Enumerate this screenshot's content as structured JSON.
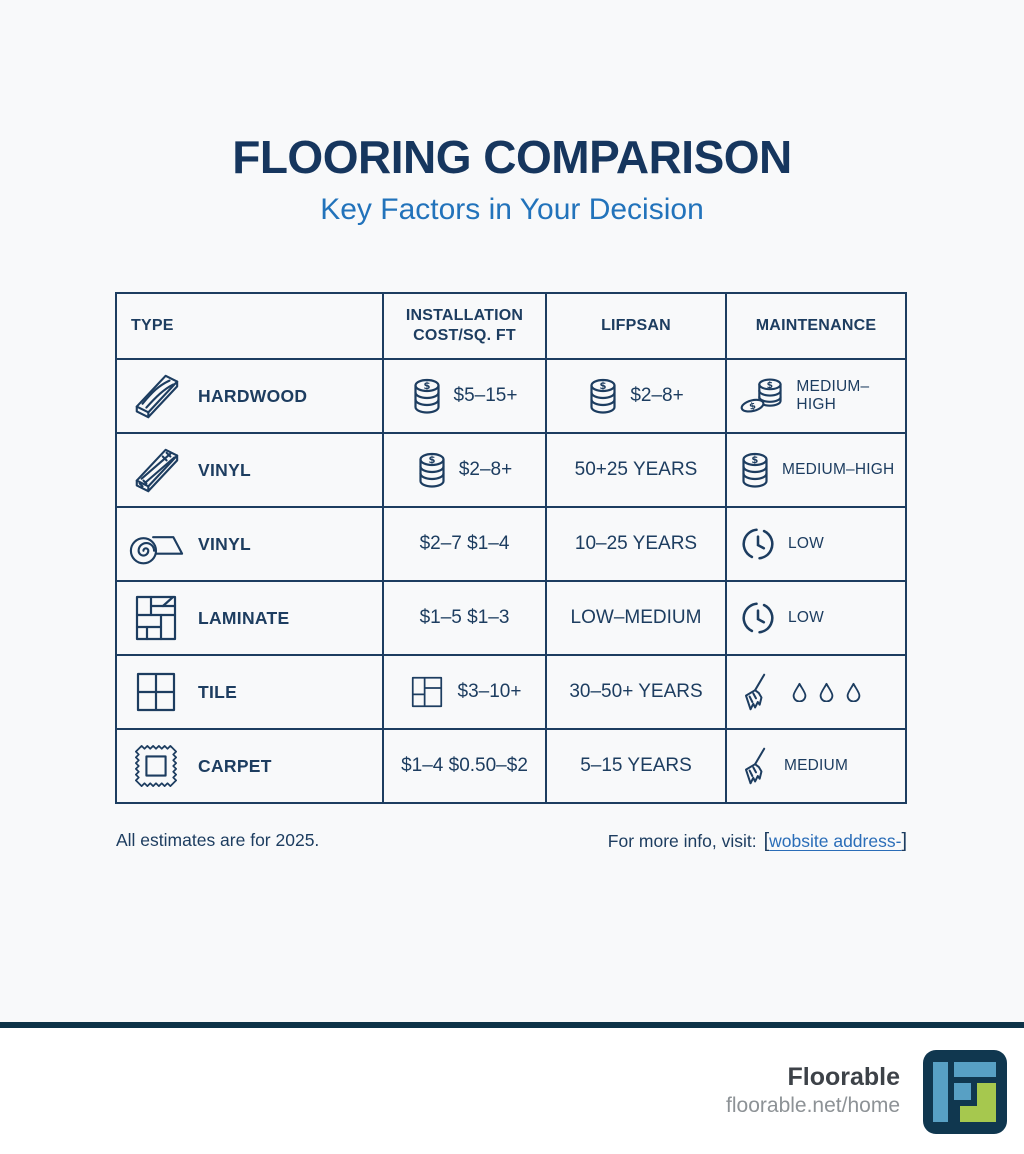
{
  "page": {
    "title": "FLOORING COMPARISON",
    "subtitle": "Key Factors in Your Decision"
  },
  "colors": {
    "navy": "#1d3d60",
    "heading_blue": "#2273bb",
    "link_blue": "#2a6db8",
    "footer_rule": "#0d3348",
    "logo_blue": "#58a0c4",
    "logo_green": "#a6c84e",
    "logo_navy": "#10374f"
  },
  "table": {
    "headers": [
      "TYPE",
      "INSTALLATION COST/SQ. FT",
      "LIFPSAN",
      "MAINTENANCE"
    ],
    "rows": [
      {
        "type": {
          "icon": "hardwood-plank-icon",
          "label": "HARDWOOD"
        },
        "cost": {
          "icon": "coin-stack-icon",
          "value": "$5–15+"
        },
        "lifespan": {
          "icon": "coin-stack-icon",
          "value": "$2–8+"
        },
        "maintenance": {
          "icon": "coin-pile-icon",
          "value": "MEDIUM–HIGH"
        }
      },
      {
        "type": {
          "icon": "vinyl-plank-icon",
          "label": "VINYL"
        },
        "cost": {
          "icon": "coin-stack-icon",
          "value": "$2–8+"
        },
        "lifespan": {
          "icon": "",
          "value": "50+25 YEARS"
        },
        "maintenance": {
          "icon": "coin-stack-icon",
          "value": "MEDIUM–HIGH"
        }
      },
      {
        "type": {
          "icon": "vinyl-roll-icon",
          "label": "VINYL"
        },
        "cost": {
          "icon": "",
          "value": "$2–7  $1–4"
        },
        "lifespan": {
          "icon": "",
          "value": "10–25 YEARS"
        },
        "maintenance": {
          "icon": "clock-icon",
          "value": "LOW"
        }
      },
      {
        "type": {
          "icon": "laminate-parquet-icon",
          "label": "LAMINATE"
        },
        "cost": {
          "icon": "",
          "value": "$1–5  $1–3"
        },
        "lifespan": {
          "icon": "",
          "value": "LOW–MEDIUM"
        },
        "maintenance": {
          "icon": "clock-icon",
          "value": "LOW"
        }
      },
      {
        "type": {
          "icon": "tile-icon",
          "label": "TILE"
        },
        "cost": {
          "icon": "tile-offset-icon",
          "value": "$3–10+"
        },
        "lifespan": {
          "icon": "",
          "value": "30–50+ YEARS"
        },
        "maintenance": {
          "icon": "broom-icon droplet-icon x3",
          "value": ""
        }
      },
      {
        "type": {
          "icon": "carpet-swatch-icon",
          "label": "CARPET"
        },
        "cost": {
          "icon": "",
          "value": "$1–4  $0.50–$2"
        },
        "lifespan": {
          "icon": "",
          "value": "5–15 YEARS"
        },
        "maintenance": {
          "icon": "broom-icon",
          "value": "MEDIUM"
        }
      }
    ]
  },
  "footnotes": {
    "left": "All estimates are for 2025.",
    "right_prefix": "For more info, visit:",
    "link_open": "[",
    "link_text": "wobsite address-",
    "link_close": "]"
  },
  "footer": {
    "brand": "Floorable",
    "url": "floorable.net/home",
    "logo": "floorable-logo"
  }
}
